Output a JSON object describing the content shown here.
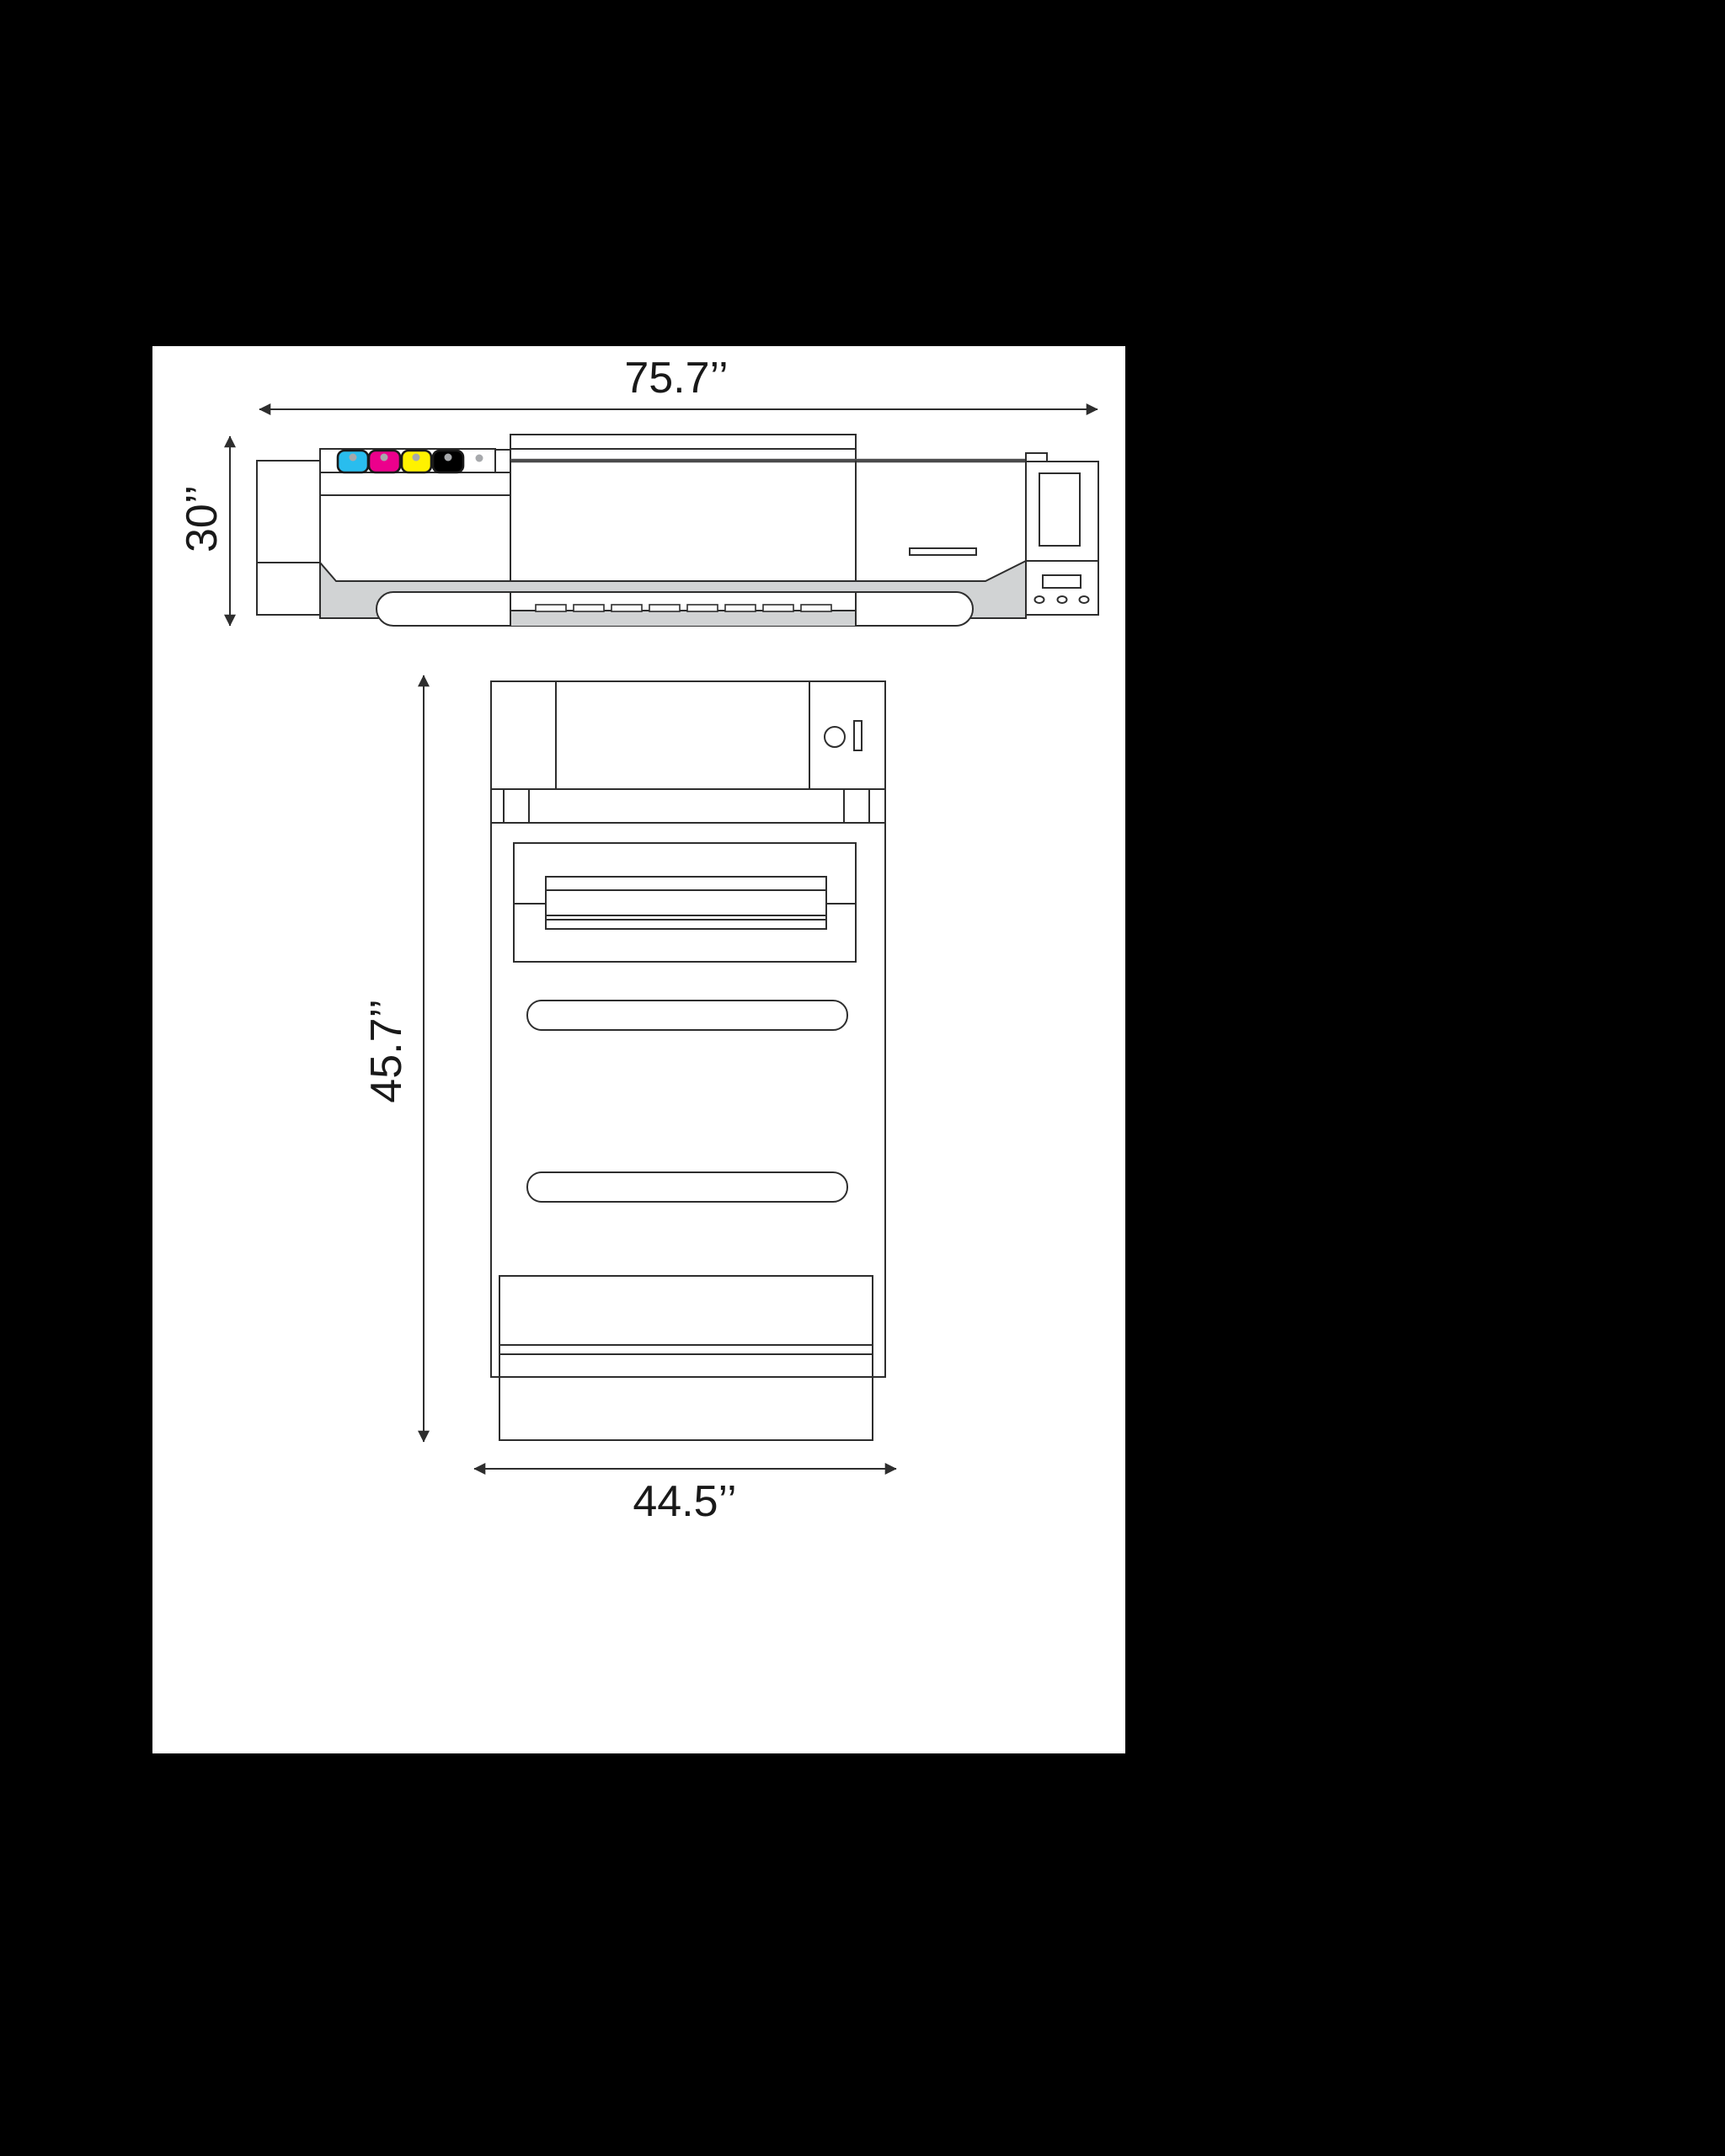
{
  "front_view": {
    "width_label": "75.7’’",
    "height_label": "30’’",
    "ink_slots": [
      "cyan",
      "magenta",
      "yellow",
      "black",
      "empty"
    ]
  },
  "top_view": {
    "depth_label": "45.7’’",
    "width_label": "44.5’’"
  },
  "colors": {
    "background": "#000000",
    "page": "#ffffff",
    "line": "#2e2e2e",
    "heavy_line": "#4b4b4c",
    "gray_fill": "#d1d3d4",
    "ink_cyan": "#29bdee",
    "ink_magenta": "#ec008c",
    "ink_yellow": "#fff200",
    "ink_black": "#000000",
    "dot_gray": "#a7a9ac"
  }
}
